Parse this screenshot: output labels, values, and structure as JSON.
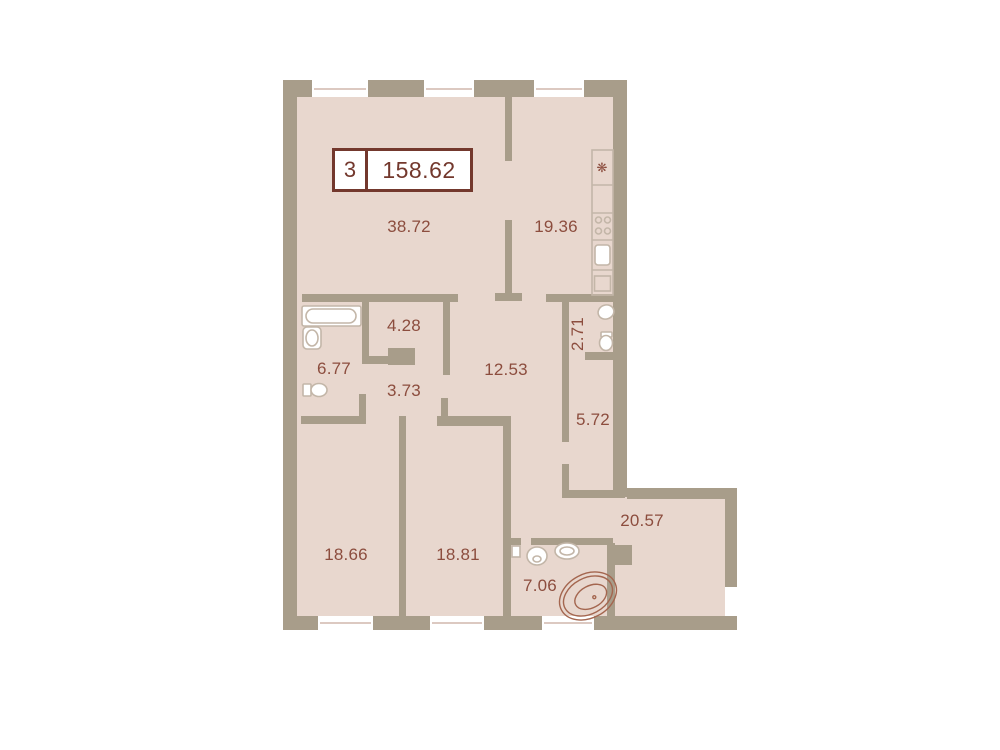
{
  "title_box": {
    "rooms_count": "3",
    "total_area": "158.62"
  },
  "rooms": [
    {
      "id": "living-room",
      "area": "38.72"
    },
    {
      "id": "kitchen",
      "area": "19.36"
    },
    {
      "id": "wardrobe",
      "area": "4.28"
    },
    {
      "id": "bathroom-1",
      "area": "6.77"
    },
    {
      "id": "hall-small",
      "area": "3.73"
    },
    {
      "id": "hallway",
      "area": "12.53"
    },
    {
      "id": "wc",
      "area": "2.71"
    },
    {
      "id": "corridor",
      "area": "5.72"
    },
    {
      "id": "bedroom-1",
      "area": "18.66"
    },
    {
      "id": "bedroom-2",
      "area": "18.81"
    },
    {
      "id": "bathroom-2",
      "area": "7.06"
    },
    {
      "id": "room-right",
      "area": "20.57"
    }
  ],
  "icons": {
    "fridge_snowflake": "❋"
  },
  "colors": {
    "wall": "#a89d8a",
    "fill": "#e8d7ce",
    "label": "#8c4d3e",
    "accent": "#73382d",
    "fixture": "#c3b6a8",
    "tub": "#a4664f",
    "window_line": "#dcc9c1",
    "bg": "#ffffff"
  }
}
